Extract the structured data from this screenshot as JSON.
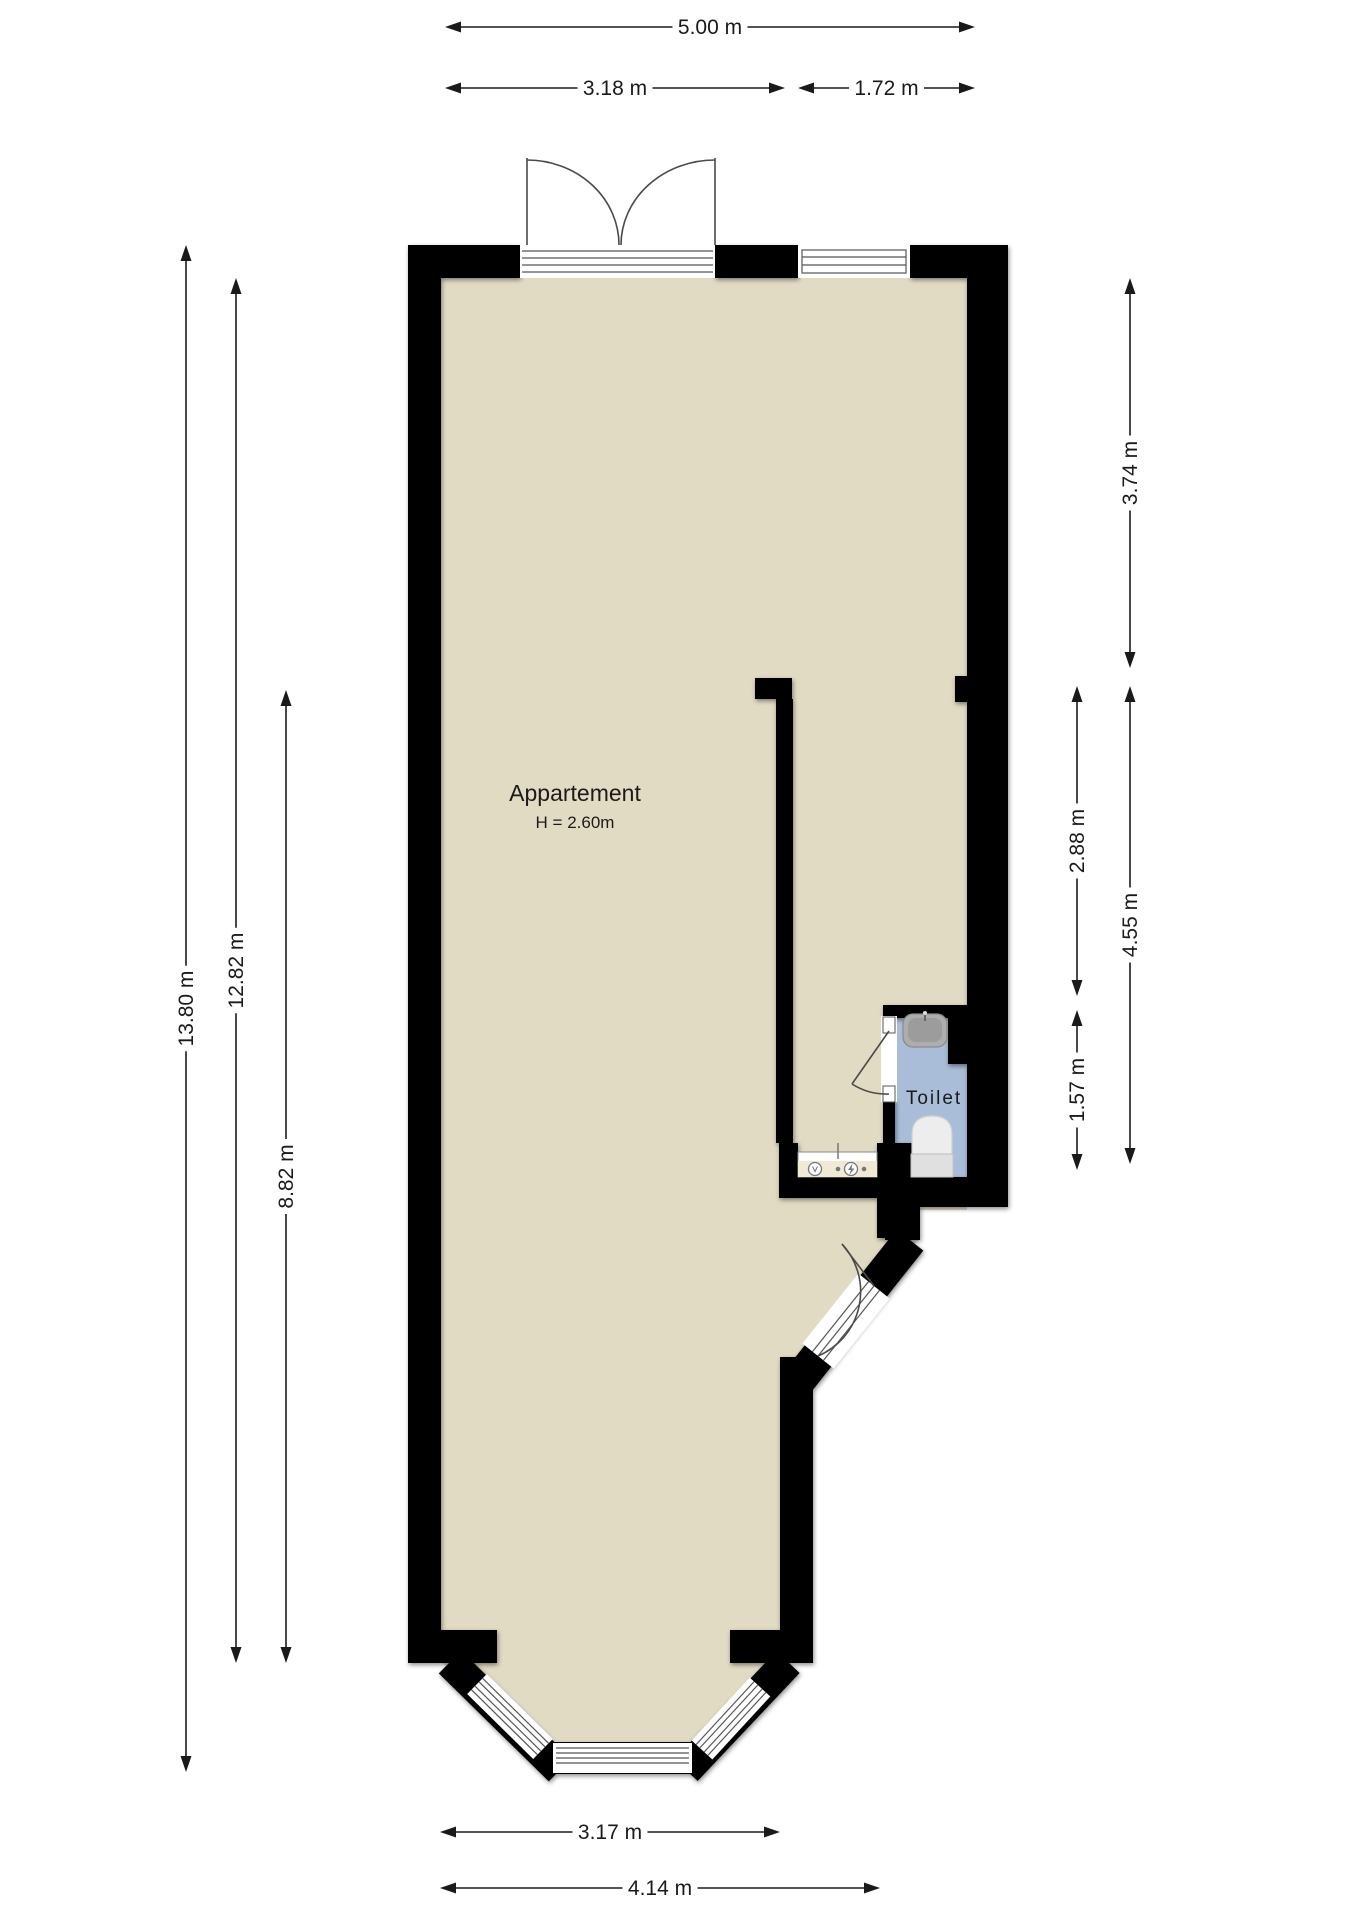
{
  "plan": {
    "rooms": {
      "apartment": {
        "name": "Appartement",
        "height": "H = 2.60m"
      },
      "toilet": {
        "name": "Toilet"
      }
    }
  },
  "colors": {
    "background": "#FFFFFF",
    "floor": "#E2DBC4",
    "toilet_floor": "#A9BDD8",
    "wall": "#000000",
    "dimension": "#1A1A1A",
    "fixture_gray": "#ADADAD",
    "fixture_light": "#EDEDED"
  },
  "dimensions": [
    {
      "label": "5.00 m",
      "x1": 445,
      "y1": 27,
      "x2": 975,
      "y2": 27
    },
    {
      "label": "3.18 m",
      "x1": 445,
      "y1": 88,
      "x2": 785,
      "y2": 88
    },
    {
      "label": "1.72 m",
      "x1": 798,
      "y1": 88,
      "x2": 975,
      "y2": 88
    },
    {
      "label": "13.80 m",
      "x1": 186,
      "y1": 245,
      "x2": 186,
      "y2": 1772
    },
    {
      "label": "12.82 m",
      "x1": 236,
      "y1": 278,
      "x2": 236,
      "y2": 1663
    },
    {
      "label": "8.82 m",
      "x1": 286,
      "y1": 690,
      "x2": 286,
      "y2": 1663
    },
    {
      "label": "3.74 m",
      "x1": 1130,
      "y1": 278,
      "x2": 1130,
      "y2": 668
    },
    {
      "label": "2.88 m",
      "x1": 1077,
      "y1": 686,
      "x2": 1077,
      "y2": 996
    },
    {
      "label": "4.55 m",
      "x1": 1130,
      "y1": 686,
      "x2": 1130,
      "y2": 1164
    },
    {
      "label": "1.57 m",
      "x1": 1077,
      "y1": 1010,
      "x2": 1077,
      "y2": 1170
    },
    {
      "label": "3.17 m",
      "x1": 440,
      "y1": 1832,
      "x2": 780,
      "y2": 1832
    },
    {
      "label": "4.14 m",
      "x1": 440,
      "y1": 1888,
      "x2": 880,
      "y2": 1888
    }
  ]
}
